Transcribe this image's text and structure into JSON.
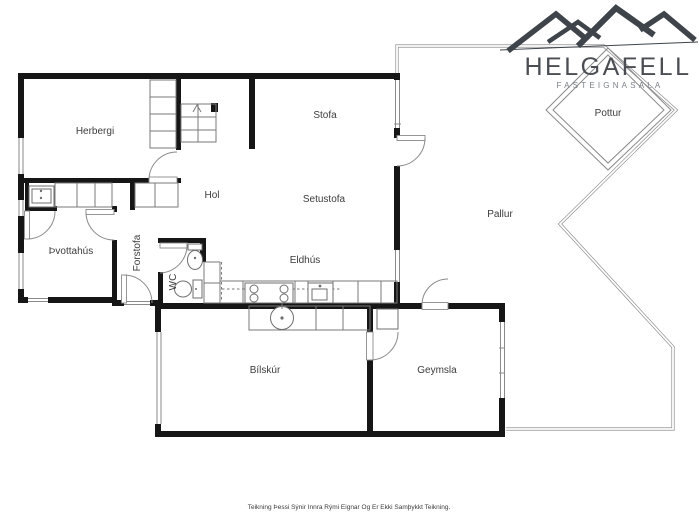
{
  "brand": {
    "logo_text": "HELGAFELL",
    "tagline": "FASTEIGNASALA"
  },
  "rooms": {
    "herbergi": "Herbergi",
    "stofa": "Stofa",
    "hol": "Hol",
    "setustofa": "Setustofa",
    "thvottahus": "Þvottahús",
    "forstofa": "Forstofa",
    "wc": "WC",
    "eldhus": "Eldhús",
    "pallur": "Pallur",
    "pottur": "Pottur",
    "bilskur": "Bílskúr",
    "geymsla": "Geymsla"
  },
  "footer": {
    "disclaimer": "Teikning Þessi Sýnir Innra Rými Eignar Og Er Ekki Samþykkt Teikning."
  },
  "colors": {
    "wall": "#161616",
    "thin_line": "#7a7a7a",
    "deck_line": "#8f8f8f",
    "label": "#3c3c3c",
    "logo": "#4a4e53",
    "logo_tagline": "#7b8187",
    "background": "#ffffff"
  }
}
